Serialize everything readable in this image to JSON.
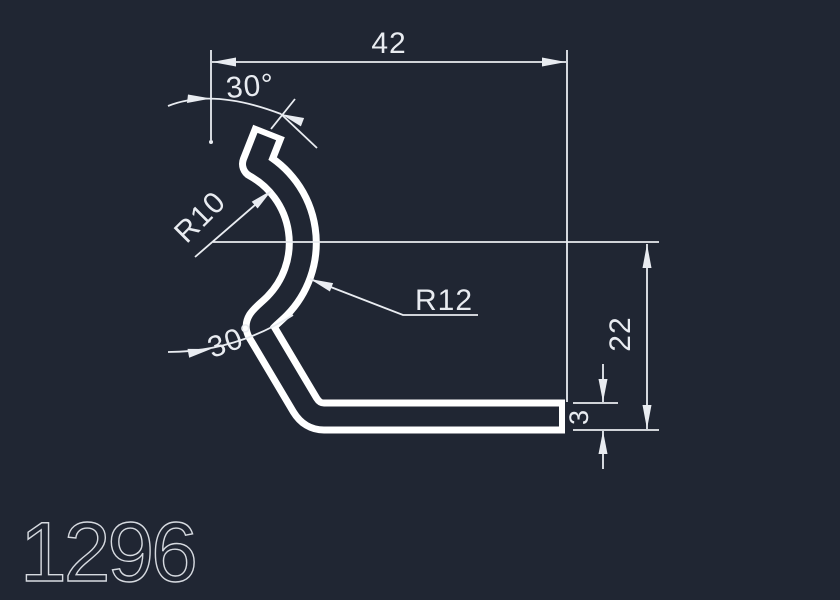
{
  "colors": {
    "background": "#202633",
    "profile": "#ffffff",
    "dimension": "#e9ecf1",
    "title": "#d6dae0"
  },
  "part": {
    "number": "1296"
  },
  "dimensions": {
    "width": "42",
    "angle_top": "30°",
    "radius_inner": "R10",
    "radius_outer": "R12",
    "height": "22",
    "thickness": "3",
    "angle_bottom": "30°"
  }
}
